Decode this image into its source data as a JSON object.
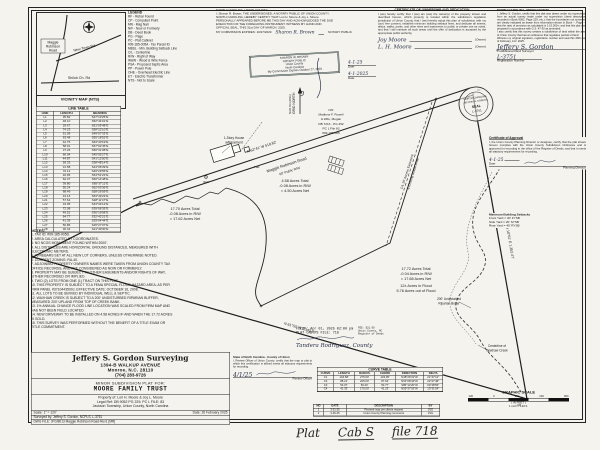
{
  "vicinity": {
    "caption": "VICINITY MAP (NTS)",
    "road_box": [
      "Maggie",
      "Robinson",
      "Road"
    ],
    "road1": "New Town Rd.",
    "road2": "Shiloh Ch. Rd"
  },
  "legend": {
    "title": "LEGEND",
    "items": [
      "RF - Rebar Found",
      "CP - Computed Point",
      "MN - Mag Nail",
      "N/F - Now or Formerly",
      "DB - Deed Book",
      "PG - Page",
      "PC - Plat Cabinet",
      "#09-185-005A - Tax Parcel ID",
      "MBSL - Min. Building Setback Line",
      "C/L - Centerline",
      "R/W - Right of Way",
      "W&W - Wood & Wire Fence",
      "PSA - Proposed Septic Area",
      "PP - Power Pole",
      "OHE - Overhead Electric Line",
      "ET - Electric Transformer",
      "NTS - Not to Scale"
    ]
  },
  "notary": {
    "body": "NORTH CAROLINA, UNION COUNTY\nI, Sharon R. Brown, THE UNDERSIGNED, A NOTARY PUBLIC OF UNION COUNTY,\nNORTH CAROLINA, HEREBY CERTIFY THAT Lori H. Moore & Joy L. Moore\nPERSONALLY APPEARED BEFORE ME THIS DAY AND ACKNOWLEDGED THE DUE\nEXECUTION OF THE FOREGOING INSTRUMENT. WITNESS MY HAND AND\nOFFICIAL SEAL, THIS 31st DAY OF MARCH, 2025.",
    "expires": "MY COMMISSION EXPIRES: 10/27/2029",
    "sig": "Sharon R. Brown",
    "sig_label": "NOTARY PUBLIC",
    "stamp": [
      "SHARON W. BROWN",
      "NOTARY PUBLIC",
      "Union County",
      "North Carolina",
      "My Commission Expires October 27, 2029"
    ]
  },
  "ownership": {
    "title": "CERTIFICATE OF OWNERSHIP AND DEDICATION",
    "body": "I (we) hereby certify that I (we) am (are) the owner(s) of the property shown and described hereon, which property is located within the subdivision regulation jurisdiction of Union County, that I (we) hereby adopt this plan of subdivision with my (our) free consent, establish minimum building setback lines, and dedicate all streets, alleys, walks, parks, and other sites and easements to public or private use as noted, and that I will maintain all such areas until the offer of dedication is accepted by the appropriate public authority.",
    "owners": [
      {
        "sig": "Joy Moore",
        "label": "(Owner)"
      },
      {
        "sig": "L. H. Moore",
        "label": "(Owner)"
      }
    ],
    "dates": [
      {
        "val": "4-1-25",
        "label": "Date"
      },
      {
        "val": "4-1-2025",
        "label": "Date"
      }
    ]
  },
  "surveyor_cert": {
    "header": "NORTH CAROLINA, UNION COUNTY",
    "body": "I, Jeffery S. Gordon, certify that this plat was drawn under my supervision from an actual survey made under my supervision (deed description recorded in Book 9052, Page 229, etc.); that the boundaries not surveyed are clearly indicated as drawn from information shown in Book --, Page --; that the ratio of precision as calculated is 1:10,000+; and that this plat was prepared in accordance with G.S. 47-30 as amended.\nI also certify that this survey creates a subdivision of land within the area of Union County that has an ordinance that regulates parcels of land.\nWitness my original signature, registration number and seal this 26th day of February, A.D. 2025.",
    "sig": "Jeffery S. Gordon",
    "sig_label": "Professional Land Surveyor",
    "reg": "L-3751",
    "reg_label": "Registration Number",
    "seal": [
      "NORTH CAROLINA",
      "JEFFERY S. GORDON",
      "SEAL",
      "L-3751"
    ]
  },
  "approval": {
    "title": "Certificate of Approval",
    "body": "I, the Union County Planning Director or designee, certify that the plat shown hereon complies with the Union County Subdivision Ordinance and is approved for recording in the office of the Register of Deeds, and that it meets all statutory requirements for recording.",
    "date": "4-1-25",
    "date_label": "Date",
    "sig_label": "Planning Director"
  },
  "setbacks": {
    "title": "Minimum Building Setbacks",
    "lines": [
      "Front Yard = 40′ FYSB",
      "Side Yard = 20′ SYSB",
      "Rear Yard = 40′ RYSB"
    ]
  },
  "line_table": {
    "title": "LINE TABLE",
    "headers": [
      "LINE",
      "LENGTH",
      "BEARING"
    ],
    "rows": [
      {
        "id": "L1",
        "len": "35.82",
        "brg": "S47°13′25″E"
      },
      {
        "id": "L2",
        "len": "48.10",
        "brg": "S52°44′01″E"
      },
      {
        "id": "L3",
        "len": "29.67",
        "brg": "S61°05′48″E"
      },
      {
        "id": "L4",
        "len": "74.23",
        "brg": "S58°22′10″E"
      },
      {
        "id": "L5",
        "len": "51.09",
        "brg": "S49°57′33″E"
      },
      {
        "id": "L6",
        "len": "63.48",
        "brg": "S55°18′52″E"
      },
      {
        "id": "L7",
        "len": "42.75",
        "brg": "S63°40′19″E"
      },
      {
        "id": "L8",
        "len": "58.91",
        "brg": "S57°02′45″E"
      },
      {
        "id": "L9",
        "len": "37.26",
        "brg": "S50°31′08″E"
      },
      {
        "id": "L10",
        "len": "66.04",
        "brg": "S45°55′27″E"
      },
      {
        "id": "L11",
        "len": "44.87",
        "brg": "S41°12′50″E"
      },
      {
        "id": "L12",
        "len": "59.33",
        "brg": "S38°48′14″E"
      },
      {
        "id": "L13",
        "len": "31.58",
        "brg": "S44°06′39″E"
      },
      {
        "id": "L14",
        "len": "70.12",
        "brg": "S49°29′55″E"
      },
      {
        "id": "L15",
        "len": "46.95",
        "brg": "S54°51′22″E"
      },
      {
        "id": "L16",
        "len": "62.37",
        "brg": "S60°14′48″E"
      },
      {
        "id": "L17",
        "len": "39.80",
        "brg": "S65°37′11″E"
      },
      {
        "id": "L18",
        "len": "55.24",
        "brg": "S62°03′36″E"
      },
      {
        "id": "L19",
        "len": "68.49",
        "brg": "S58°26′59″E"
      },
      {
        "id": "L20",
        "len": "43.16",
        "brg": "S53°49′23″E"
      },
      {
        "id": "L21",
        "len": "57.62",
        "brg": "S48°11′47″E"
      },
      {
        "id": "L22",
        "len": "34.95",
        "brg": "S43°34′12″E"
      },
      {
        "id": "L23",
        "len": "72.08",
        "brg": "S39°56′35″E"
      },
      {
        "id": "L24",
        "len": "49.51",
        "brg": "S36°19′58″E"
      },
      {
        "id": "L25",
        "len": "64.77",
        "brg": "S32°42′21″E"
      },
      {
        "id": "L26",
        "len": "41.39",
        "brg": "S29°04′44″E"
      },
      {
        "id": "L27",
        "len": "56.86",
        "brg": "S25°27′07″E"
      },
      {
        "id": "L28",
        "len": "30.44",
        "brg": "S21°49′30″E"
      }
    ]
  },
  "curve_table": {
    "title": "CURVE TABLE",
    "headers": [
      "CURVE",
      "LENGTH",
      "RADIUS",
      "CHORD",
      "DIRECTION",
      "DELTA"
    ],
    "rows": [
      {
        "id": "C1",
        "len": "104.58′",
        "rad": "275.00′",
        "chord": "103.95′",
        "dir": "N48°26′31″W",
        "delta": "21°47′12″"
      },
      {
        "id": "C2",
        "len": "88.21′",
        "rad": "225.00′",
        "chord": "87.64′",
        "dir": "N51°08′44″W",
        "delta": "22°27′48″"
      },
      {
        "id": "C3",
        "len": "53.07′",
        "rad": "50.00′",
        "chord": "50.77′",
        "dir": "S85°12′20″W",
        "delta": "60°48′55″"
      },
      {
        "id": "C4",
        "len": "41.33′",
        "rad": "175.00′",
        "chord": "41.23′",
        "dir": "N55°37′02″W",
        "delta": "13°31′54″"
      }
    ]
  },
  "notes": {
    "title": "NOTES:",
    "items": [
      "TAX ID: #09-185-005D.",
      "AREA CALCULATED BY COORDINATES.",
      "NO NCGS MONUMENT FOUND WITHIN 2000′.",
      "ALL DISTANCES ARE HORIZONTAL GROUND DISTANCES, MEASURED WITH ELECTRONIC METERS.",
      "#5 REBARS SET AT ALL NEW LOT CORNERS, UNLESS OTHERWISE NOTED.",
      "CURRENT ZONING: RA-40.",
      "ADJOINING PROPERTY OWNERS NAMES WERE TAKEN FROM UNION COUNTY TAX OFFICE RECORDS, AND ARE CONSIDERED AS NOW OR FORMERLY.",
      "PROPERTY MAY BE SUBJECT TO OTHER EASEMENTS AND/OR RIGHTS OF WAY, EITHER RECORDED OR IMPLIED.",
      "TWO (2) LOTS FROM ONE (1) TRACT ON THIS PLAT.",
      "THIS PROPERTY IS SUBJECT TO A FEMA SPECIAL FLOOD HAZARD AREA, AS PER FIRM PANEL #3710443500J, EFFECTIVE DATE: OCTOBER 16, 2008.",
      "ALL LOTS TO BE SERVED BY INDIVIDUAL WELL & SEPTIC.",
      "WAXHAW CREEK IS SUBJECT TO A 200′ UNDISTURBED RIPARIAN BUFFER, MEASURED 200′ UPLAND FROM TOP OF CREEK BANK.",
      "1% ANNUAL CHANCE FLOOD LINE LOCATION WAS SCALED FROM FIRM MAP AND HAS NOT BEEN FIELD LOCATED.",
      "NEW DRIVEWAY TO BE INSTALLED ON 4.58 ACRES IF AND WHEN THE 17.72 ACRES IS SOLD.",
      "THIS SURVEY WAS PERFORMED WITHOUT THE BENEFIT OF A TITLE EXAM OR TITLE COMMITMENT."
    ]
  },
  "title_block": {
    "firm": "Jeffery S. Gordon Surveying",
    "addr1": "1394-B WALKUP AVENUE",
    "addr2": "Monroe, N.C.  28110",
    "phone": "(704) 283-9726",
    "plat_for": "MINOR SUBDIVISION PLAT FOR:",
    "client": "MOORE FAMILY TRUST",
    "property": "Property of: Lori H. Moore & Joy L. Moore",
    "legal": "Legal Ref: DB 9052 PG 229; PC L FILE: 83",
    "township": "Jackson Township, Union County, North Carolina",
    "scale": "Scale: 1″ = 120′",
    "date": "Date: 26 February 2025",
    "surveyed": "Surveyed by:  Jeffery S. Gordon, NCPLS, L-3751",
    "dwg": "DWG FILE:  JFG/8013 Maggie Robinson Road-Rev1 [MR]"
  },
  "review": {
    "header": "State of North Carolina - County of Union",
    "body": "I, Review Officer of Union County, certify that the map or plat to which this certification is affixed meets all statutory requirements for recording.",
    "sig_label": "Review Officer",
    "date": "4/1/25"
  },
  "revisions": {
    "headers": [
      "NO",
      "DATE",
      "DESCRIPTION",
      "BY"
    ],
    "rows": [
      {
        "no": "1",
        "date": "3-21-25",
        "desc": "Revised map per clients request",
        "by": "JSG"
      },
      {
        "no": "2",
        "date": "3-26-25",
        "desc": "Union County Planning comments",
        "by": "JSG"
      }
    ]
  },
  "filed": {
    "line1": "FILED: Apr 01, 2025  02:00 pm",
    "line2": "PLAT CAB: S    FILE: 718",
    "hand": "Tandera Rodriguez, County",
    "side": [
      "FEE: $21.00",
      "Union County, NC",
      "Register of Deeds"
    ]
  },
  "scalebar": {
    "title": "GRAPHIC SCALE",
    "ticks": [
      "120",
      "0",
      "120",
      "240",
      "360"
    ],
    "feet": "( IN FEET )",
    "inch": "1 inch = 120 ft."
  },
  "map": {
    "road_name": "Maggie Robinson Road",
    "road_rw": "60′ Public R/W",
    "road_bearing": "N 62°41′ W   519.82′",
    "south_bearing": "N 61°52′ W   2,145.60′",
    "east_bearing": "S 10°01′ E   1,352.47′",
    "north_label": "GRID NORTH",
    "datum": "NAD 83 (2011)",
    "lot1": [
      "4.58 Acres Total",
      "-0.08 Acres in R/W",
      "= 4.50 Acres Net"
    ],
    "lot2": [
      "17.70 Acres Total",
      "-0.08 Acres in R/W",
      "= 17.62 Acres Net"
    ],
    "lot3": [
      "17.72 Acres Total",
      "-0.04 Acres in R/W",
      "= 17.68 Acres Net",
      "12± Acres in Flood",
      "5.76 Acres out of Flood"
    ],
    "house1": "1-Story House",
    "house2": "w/Basement",
    "pad": "Pad",
    "well": "Well",
    "easement1": "C/L 30′ Access Easement",
    "easement2": "& Existing Gravel Drive",
    "buffer1": "200′ Undisturbed",
    "buffer2": "Riparian Buffer",
    "creek1": "Centerline of",
    "creek2": "Waxhaw Creek",
    "adjoiner": [
      "N/F",
      "Matthew F. Powell",
      "& Wife, Megan",
      "DB 7213 - PG 252",
      "PC L File 83",
      "#09-185-005"
    ],
    "corner_cp": "CP",
    "corner_rf": "RF"
  },
  "hand": {
    "w1": "Plat",
    "w2": "Cab S",
    "w3": "file 718"
  }
}
